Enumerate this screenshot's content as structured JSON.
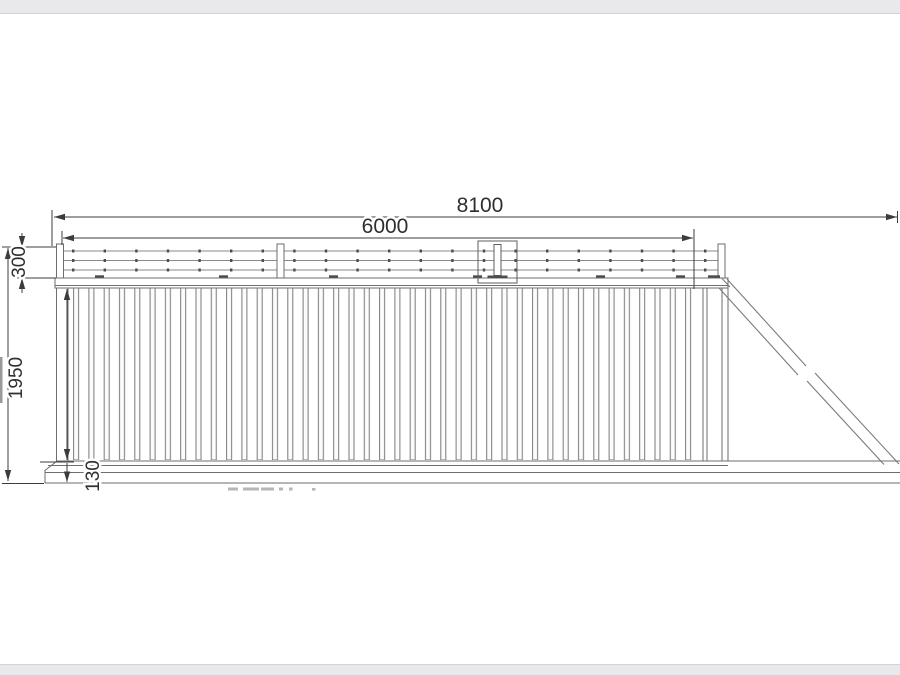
{
  "drawing": {
    "subject": "cantilever sliding gate elevation drawing",
    "dimensions": {
      "total_width": "8100",
      "opening_width": "6000",
      "topper_height": "300",
      "body_height": "1950",
      "bottom_rail_height": "130"
    },
    "colors": {
      "dimension_lines": "#3c3c3c",
      "gate_lines": "#6e6e6e",
      "edge_bars": "#e9e9ec",
      "faint_marks": "#b5b5ba"
    }
  }
}
